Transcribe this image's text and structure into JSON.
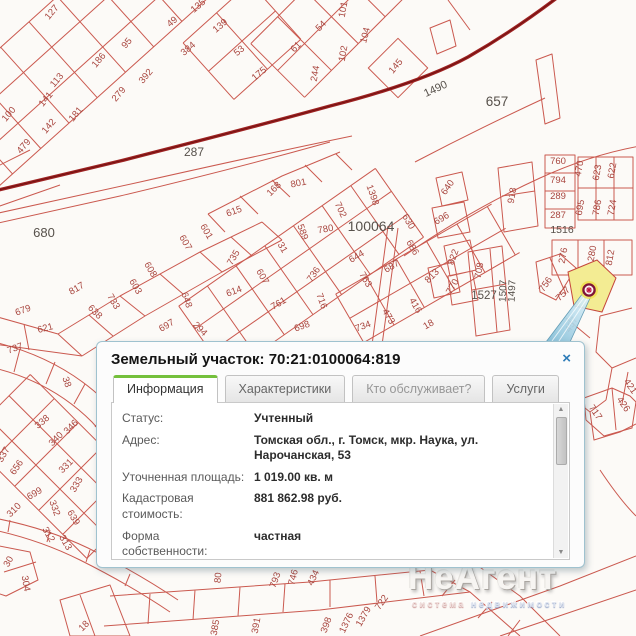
{
  "popup": {
    "title": "Земельный участок: 70:21:0100064:819",
    "tabs": [
      {
        "label": "Информация",
        "active": true
      },
      {
        "label": "Характеристики",
        "active": false
      },
      {
        "label": "Кто обслуживает?",
        "active": false
      },
      {
        "label": "Услуги",
        "active": false
      }
    ],
    "fields": [
      {
        "label": "Статус:",
        "value": "Учтенный"
      },
      {
        "label": "Адрес:",
        "value": "Томская обл., г. Томск, мкр. Наука, ул. Нарочанская, 53"
      },
      {
        "label": "Уточненная площадь:",
        "value": "1 019.00 кв. м"
      },
      {
        "label": "Кадастровая стоимость:",
        "value": "881 862.98 руб."
      },
      {
        "label": "Форма собственности:",
        "value": "частная"
      },
      {
        "label": "Дата постановки на учет:",
        "value": "10.10.2011"
      }
    ]
  },
  "icons": {
    "close": "×",
    "scroll_up": "▲",
    "scroll_down": "▼"
  },
  "watermark": {
    "brand": "НеАгент",
    "tagline_1": "система",
    "tagline_2": "недвижимости"
  },
  "map": {
    "cadastral_block": "100064",
    "colors": {
      "parcel_line": "#c5473c",
      "road": "#9e2222",
      "parcel_number": "#a8453e",
      "block_number": "#57514b",
      "highlight_fill": "#f3ec93",
      "marker_ring": "#7e1538",
      "marker_center": "#c01540",
      "pointer_fill": "#9fd0e4"
    },
    "block_labels": [
      {
        "t": "287",
        "x": 194,
        "y": 156,
        "r": 0,
        "s": 12
      },
      {
        "t": "680",
        "x": 44,
        "y": 237,
        "r": 0,
        "s": 13
      },
      {
        "t": "657",
        "x": 497,
        "y": 106,
        "r": 0,
        "s": 13.5
      },
      {
        "t": "100064",
        "x": 371,
        "y": 231,
        "r": 0,
        "s": 14
      },
      {
        "t": "1490",
        "x": 437,
        "y": 92,
        "r": -25,
        "s": 11
      },
      {
        "t": "1516",
        "x": 562,
        "y": 233,
        "r": 0,
        "s": 10.5
      },
      {
        "t": "1527",
        "x": 484,
        "y": 299,
        "r": 0,
        "s": 11.5
      },
      {
        "t": "1507",
        "x": 506,
        "y": 291,
        "r": -88,
        "s": 10
      },
      {
        "t": "1497",
        "x": 515,
        "y": 291,
        "r": -88,
        "s": 10
      }
    ],
    "parcel_numbers": [
      {
        "t": "127",
        "x": 54,
        "y": 14,
        "r": -50
      },
      {
        "t": "135",
        "x": 200,
        "y": 8,
        "r": -40
      },
      {
        "t": "49",
        "x": 174,
        "y": 24,
        "r": -40
      },
      {
        "t": "384",
        "x": 190,
        "y": 51,
        "r": -40
      },
      {
        "t": "95",
        "x": 129,
        "y": 45,
        "r": -50
      },
      {
        "t": "186",
        "x": 101,
        "y": 62,
        "r": -50
      },
      {
        "t": "392",
        "x": 148,
        "y": 78,
        "r": -50
      },
      {
        "t": "279",
        "x": 121,
        "y": 96,
        "r": -50
      },
      {
        "t": "113",
        "x": 59,
        "y": 82,
        "r": -50
      },
      {
        "t": "141",
        "x": 48,
        "y": 101,
        "r": -50
      },
      {
        "t": "100",
        "x": 11,
        "y": 116,
        "r": -50
      },
      {
        "t": "181",
        "x": 78,
        "y": 116,
        "r": -50
      },
      {
        "t": "142",
        "x": 51,
        "y": 128,
        "r": -50
      },
      {
        "t": "479",
        "x": 26,
        "y": 148,
        "r": -50
      },
      {
        "t": "139",
        "x": 222,
        "y": 28,
        "r": -40
      },
      {
        "t": "53",
        "x": 241,
        "y": 53,
        "r": -40
      },
      {
        "t": "175",
        "x": 261,
        "y": 76,
        "r": -40
      },
      {
        "t": "61",
        "x": 298,
        "y": 49,
        "r": -45
      },
      {
        "t": "54",
        "x": 323,
        "y": 28,
        "r": -45
      },
      {
        "t": "101",
        "x": 346,
        "y": 10,
        "r": -80
      },
      {
        "t": "104",
        "x": 368,
        "y": 36,
        "r": -75
      },
      {
        "t": "102",
        "x": 346,
        "y": 54,
        "r": -80
      },
      {
        "t": "244",
        "x": 318,
        "y": 74,
        "r": -80
      },
      {
        "t": "145",
        "x": 398,
        "y": 68,
        "r": -50
      },
      {
        "t": "168",
        "x": 276,
        "y": 191,
        "r": -45
      },
      {
        "t": "801",
        "x": 299,
        "y": 186,
        "r": -12
      },
      {
        "t": "615",
        "x": 235,
        "y": 214,
        "r": -20
      },
      {
        "t": "702",
        "x": 338,
        "y": 211,
        "r": 65
      },
      {
        "t": "1398",
        "x": 370,
        "y": 196,
        "r": 70
      },
      {
        "t": "589",
        "x": 300,
        "y": 233,
        "r": 70
      },
      {
        "t": "780",
        "x": 326,
        "y": 232,
        "r": -10
      },
      {
        "t": "31",
        "x": 280,
        "y": 249,
        "r": 60
      },
      {
        "t": "630",
        "x": 406,
        "y": 223,
        "r": 60
      },
      {
        "t": "735",
        "x": 236,
        "y": 259,
        "r": -60
      },
      {
        "t": "607",
        "x": 260,
        "y": 278,
        "r": 60
      },
      {
        "t": "614",
        "x": 235,
        "y": 294,
        "r": -20
      },
      {
        "t": "761",
        "x": 280,
        "y": 306,
        "r": -30
      },
      {
        "t": "736",
        "x": 316,
        "y": 276,
        "r": -55
      },
      {
        "t": "716",
        "x": 319,
        "y": 302,
        "r": 70
      },
      {
        "t": "698",
        "x": 303,
        "y": 329,
        "r": -20
      },
      {
        "t": "644",
        "x": 358,
        "y": 259,
        "r": -30
      },
      {
        "t": "763",
        "x": 363,
        "y": 281,
        "r": 60
      },
      {
        "t": "687",
        "x": 393,
        "y": 269,
        "r": -30
      },
      {
        "t": "686",
        "x": 410,
        "y": 249,
        "r": 60
      },
      {
        "t": "734",
        "x": 364,
        "y": 329,
        "r": -20
      },
      {
        "t": "473",
        "x": 386,
        "y": 318,
        "r": 60
      },
      {
        "t": "416",
        "x": 413,
        "y": 307,
        "r": 60
      },
      {
        "t": "18",
        "x": 430,
        "y": 327,
        "r": -30
      },
      {
        "t": "817",
        "x": 78,
        "y": 291,
        "r": -30
      },
      {
        "t": "733",
        "x": 111,
        "y": 303,
        "r": 60
      },
      {
        "t": "638",
        "x": 93,
        "y": 314,
        "r": 45
      },
      {
        "t": "603",
        "x": 133,
        "y": 288,
        "r": 60
      },
      {
        "t": "608",
        "x": 148,
        "y": 271,
        "r": 60
      },
      {
        "t": "607",
        "x": 183,
        "y": 244,
        "r": 60
      },
      {
        "t": "601",
        "x": 204,
        "y": 233,
        "r": 60
      },
      {
        "t": "679",
        "x": 24,
        "y": 313,
        "r": -20
      },
      {
        "t": "621",
        "x": 46,
        "y": 331,
        "r": -15
      },
      {
        "t": "697",
        "x": 168,
        "y": 328,
        "r": -30
      },
      {
        "t": "648",
        "x": 184,
        "y": 301,
        "r": 70
      },
      {
        "t": "294",
        "x": 198,
        "y": 331,
        "r": 45
      },
      {
        "t": "640",
        "x": 450,
        "y": 189,
        "r": -55
      },
      {
        "t": "696",
        "x": 443,
        "y": 221,
        "r": -30
      },
      {
        "t": "918",
        "x": 515,
        "y": 196,
        "r": -80
      },
      {
        "t": "760",
        "x": 558,
        "y": 164,
        "r": 0
      },
      {
        "t": "794",
        "x": 558,
        "y": 183,
        "r": 0
      },
      {
        "t": "289",
        "x": 558,
        "y": 199,
        "r": 0
      },
      {
        "t": "287",
        "x": 558,
        "y": 218,
        "r": 0
      },
      {
        "t": "470",
        "x": 582,
        "y": 169,
        "r": -80
      },
      {
        "t": "623",
        "x": 600,
        "y": 173,
        "r": -80
      },
      {
        "t": "622",
        "x": 615,
        "y": 171,
        "r": -80
      },
      {
        "t": "695",
        "x": 583,
        "y": 208,
        "r": -80
      },
      {
        "t": "786",
        "x": 600,
        "y": 208,
        "r": -80
      },
      {
        "t": "724",
        "x": 615,
        "y": 208,
        "r": -80
      },
      {
        "t": "276",
        "x": 566,
        "y": 256,
        "r": -80
      },
      {
        "t": "280",
        "x": 595,
        "y": 254,
        "r": -80
      },
      {
        "t": "812",
        "x": 613,
        "y": 258,
        "r": -80
      },
      {
        "t": "708",
        "x": 482,
        "y": 271,
        "r": -80
      },
      {
        "t": "822",
        "x": 456,
        "y": 258,
        "r": -70
      },
      {
        "t": "813",
        "x": 434,
        "y": 278,
        "r": -45
      },
      {
        "t": "770",
        "x": 455,
        "y": 288,
        "r": -60
      },
      {
        "t": "756",
        "x": 548,
        "y": 286,
        "r": -55
      },
      {
        "t": "757",
        "x": 565,
        "y": 296,
        "r": -45
      },
      {
        "t": "737",
        "x": 16,
        "y": 351,
        "r": -20
      },
      {
        "t": "38",
        "x": 64,
        "y": 383,
        "r": 70
      },
      {
        "t": "338",
        "x": 44,
        "y": 424,
        "r": -40
      },
      {
        "t": "346",
        "x": 73,
        "y": 429,
        "r": -45
      },
      {
        "t": "340",
        "x": 58,
        "y": 441,
        "r": -45
      },
      {
        "t": "337",
        "x": 6,
        "y": 456,
        "r": -60
      },
      {
        "t": "656",
        "x": 19,
        "y": 469,
        "r": -55
      },
      {
        "t": "331",
        "x": 68,
        "y": 468,
        "r": -45
      },
      {
        "t": "333",
        "x": 79,
        "y": 486,
        "r": -60
      },
      {
        "t": "310",
        "x": 16,
        "y": 512,
        "r": -45
      },
      {
        "t": "699",
        "x": 36,
        "y": 496,
        "r": -30
      },
      {
        "t": "332",
        "x": 52,
        "y": 509,
        "r": 70
      },
      {
        "t": "639",
        "x": 71,
        "y": 519,
        "r": 60
      },
      {
        "t": "312",
        "x": 46,
        "y": 536,
        "r": 60
      },
      {
        "t": "313",
        "x": 63,
        "y": 544,
        "r": 60
      },
      {
        "t": "30",
        "x": 11,
        "y": 563,
        "r": -60
      },
      {
        "t": "304",
        "x": 23,
        "y": 584,
        "r": 80
      },
      {
        "t": "18",
        "x": 86,
        "y": 628,
        "r": -45
      },
      {
        "t": "80",
        "x": 221,
        "y": 578,
        "r": -85
      },
      {
        "t": "793",
        "x": 278,
        "y": 581,
        "r": -70
      },
      {
        "t": "746",
        "x": 296,
        "y": 578,
        "r": -75
      },
      {
        "t": "434",
        "x": 316,
        "y": 579,
        "r": -65
      },
      {
        "t": "722",
        "x": 384,
        "y": 604,
        "r": -55
      },
      {
        "t": "1379",
        "x": 366,
        "y": 618,
        "r": -60
      },
      {
        "t": "1376",
        "x": 349,
        "y": 624,
        "r": -65
      },
      {
        "t": "398",
        "x": 329,
        "y": 626,
        "r": -70
      },
      {
        "t": "391",
        "x": 259,
        "y": 626,
        "r": -80
      },
      {
        "t": "385",
        "x": 218,
        "y": 628,
        "r": -80
      },
      {
        "t": "717",
        "x": 593,
        "y": 414,
        "r": 55
      },
      {
        "t": "426",
        "x": 621,
        "y": 406,
        "r": 55
      },
      {
        "t": "421",
        "x": 628,
        "y": 388,
        "r": 55
      },
      {
        "t": "457",
        "x": 574,
        "y": 326,
        "r": -60
      }
    ]
  }
}
